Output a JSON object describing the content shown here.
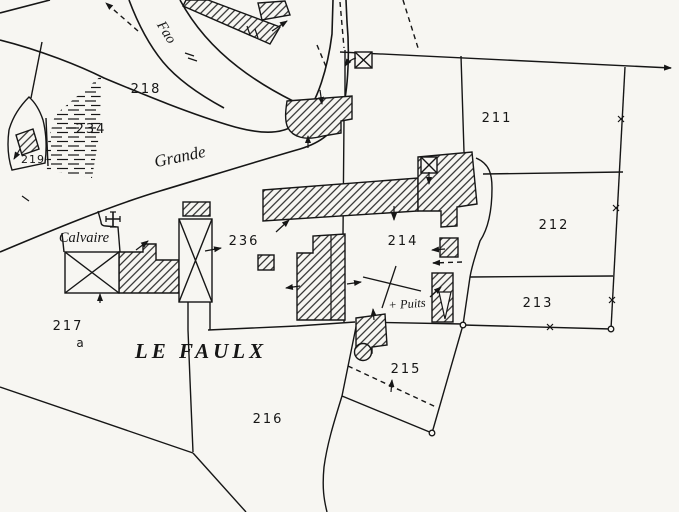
{
  "map": {
    "type": "cadastral-plan",
    "place_name": "LE FAULX",
    "streets": [
      {
        "label": "Grande"
      },
      {
        "label": "Fao"
      }
    ],
    "landmarks": [
      {
        "label": "Calvaire",
        "symbol": "wayside-cross"
      },
      {
        "label": "+ Puits",
        "symbol": "well-marker"
      }
    ],
    "parcels": [
      {
        "number": "211"
      },
      {
        "number": "212"
      },
      {
        "number": "213"
      },
      {
        "number": "214"
      },
      {
        "number": "215"
      },
      {
        "number": "216"
      },
      {
        "number": "217",
        "suffix": "a"
      },
      {
        "number": "218"
      },
      {
        "number": "219"
      },
      {
        "number": "234"
      },
      {
        "number": "236"
      }
    ],
    "colors": {
      "ink": "#161616",
      "paper": "#f7f6f2"
    }
  }
}
